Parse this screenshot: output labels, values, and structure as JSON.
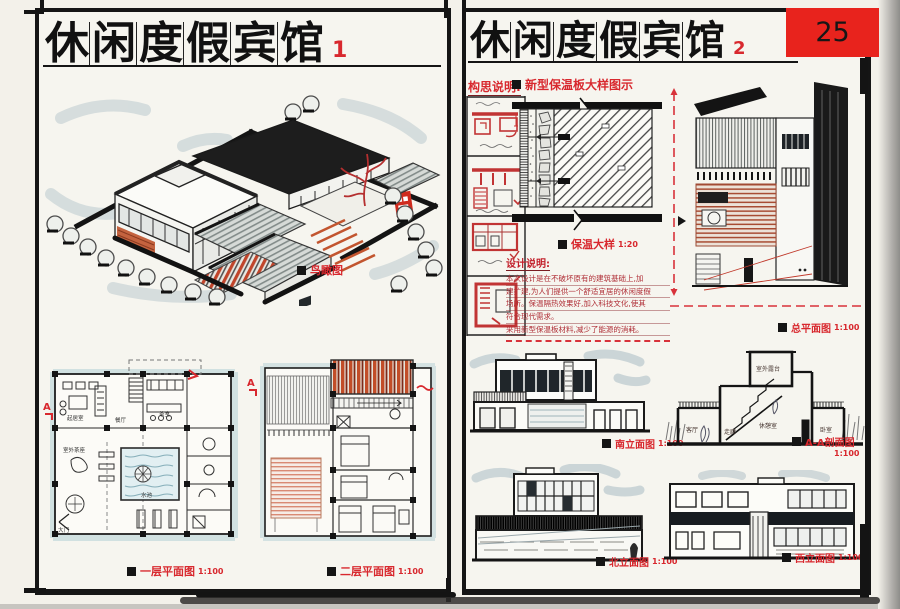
{
  "page": {
    "sheet_number": "25"
  },
  "left": {
    "title_chars": [
      "休",
      "闲",
      "度",
      "假",
      "宾",
      "馆"
    ],
    "index": "1",
    "aerial_label": "鸟瞰图",
    "plan1_label": "一层平面图",
    "plan1_scale": "1:100",
    "plan2_label": "二层平面图",
    "plan2_scale": "1:100",
    "section_marker": "A",
    "plan1_rooms": {
      "living": "起居室",
      "dining": "餐厅",
      "tea": "茶室",
      "pool": "水池",
      "terrace": "室外茶座",
      "gate": "大门"
    }
  },
  "right": {
    "title_chars": [
      "休",
      "闲",
      "度",
      "假",
      "宾",
      "馆"
    ],
    "index": "2",
    "concept_heading": "构思说明:",
    "detail_heading": "新型保温板大样图示",
    "detail_label": "保温大样",
    "detail_scale": "1:20",
    "notes_heading": "设计说明:",
    "notes_lines": [
      "本次设计是在不破坏原有的建筑基础上,加",
      "建扩建,为人们提供一个舒适宜居的休闲度假",
      "场所。保温隔热效果好,加入科技文化,使其",
      "符合现代需求。",
      "采用新型保温板材料,减少了能源的消耗。"
    ],
    "site_label": "总平面图",
    "site_scale": "1:100",
    "south_label": "南立面图",
    "south_scale": "1:100",
    "section_label": "A-A剖面图",
    "section_scale": "1:100",
    "north_label": "北立面图",
    "north_scale": "1:100",
    "west_label": "西立面图",
    "west_scale": "1:100",
    "section_marker": "A",
    "section_rooms": {
      "terrace": "室外露台",
      "living": "客厅",
      "hall": "走廊",
      "rest": "休憩室",
      "bed": "卧室"
    }
  },
  "colors": {
    "accent_red": "#d8282e",
    "ink": "#151515",
    "marker_blue": "#aabfc7",
    "marker_orange": "#c25a34"
  }
}
